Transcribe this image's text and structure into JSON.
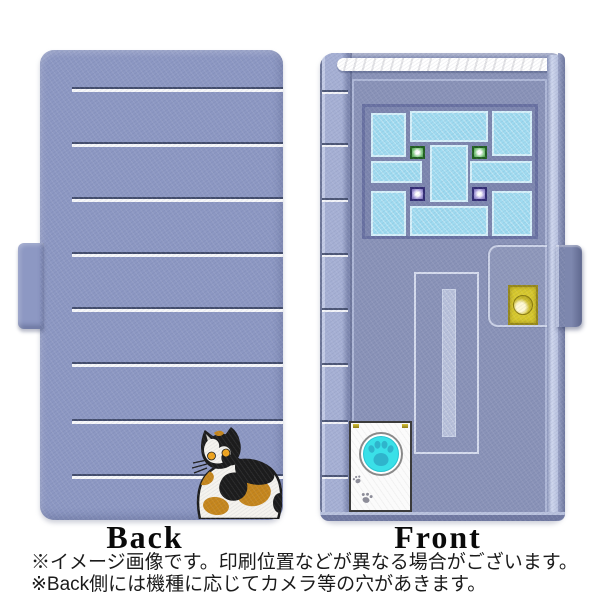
{
  "views": {
    "back_label": "Back",
    "front_label": "Front"
  },
  "notes": {
    "line1": "※イメージ画像です。印刷位置などが異なる場合がございます。",
    "line2": "※Back側には機種に応じてカメラ等の穴があきます。"
  },
  "design": {
    "back_stripe_offsets_px": [
      37,
      92,
      147,
      202,
      257,
      312,
      369,
      424
    ],
    "spine_band_offsets_px": [
      37,
      90,
      145,
      200,
      255,
      310,
      367,
      422
    ],
    "window_leds": [
      "green",
      "green",
      "purple",
      "purple"
    ],
    "icons": {
      "cat": "calico-cat-illustration",
      "doorbell_button": "paw-print-icon",
      "paw_prints": "paw-prints-icon",
      "snap_button": "snap-button-icon"
    }
  },
  "colors": {
    "case-periwinkle": "#8d98c3",
    "door-face": "#8a93b8",
    "spine": "#a6b0d4",
    "fore-edge": "#cfd7ee",
    "stripe-white": "#ffffff",
    "stripe-dark": "#3d4766",
    "window-pane": "#9edaf0",
    "pane-border": "#d5f0fa",
    "window-frame": "#7d86af",
    "window-border": "#6971a2",
    "led-green": "#3f9c3f",
    "led-purple": "#6c61b0",
    "gold": "#d8c92e",
    "cyan-button": "#3ae0e8",
    "paw-teal": "#2fb4cc",
    "cat-orange": "#c5861d",
    "cat-black": "#1c1c1c",
    "cat-eye": "#f0a41c"
  }
}
